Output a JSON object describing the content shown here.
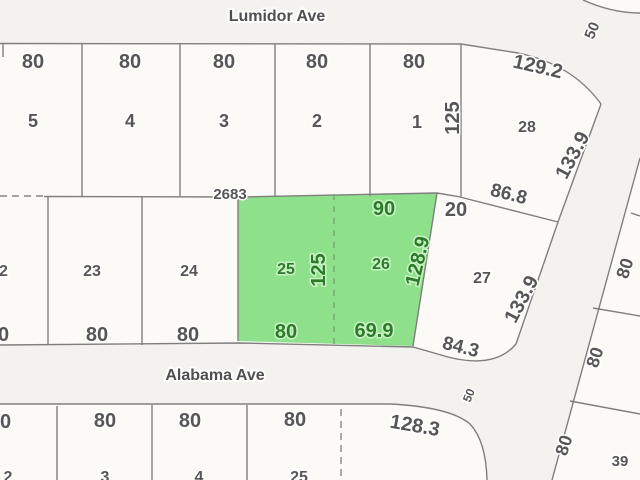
{
  "streets": {
    "north": "Lumidor Ave",
    "south": "Alabama Ave",
    "diagonal_width_top": "50",
    "intersection_width": "50"
  },
  "plat_number": "2683",
  "north_block": {
    "frontages": [
      "80",
      "80",
      "80",
      "80",
      "80"
    ],
    "lot_numbers": [
      "5",
      "4",
      "3",
      "2",
      "1"
    ],
    "depth": "125",
    "corner_lot": {
      "number": "28",
      "top_dim": "129.2",
      "side_dim": "133.9",
      "bottom_dim": "86.8"
    }
  },
  "middle_block": {
    "lot_numbers": [
      "22",
      "23",
      "24"
    ],
    "frontages": [
      "80",
      "80",
      "80"
    ],
    "east_lot": {
      "number": "27",
      "top_dim": "20",
      "side_dim": "133.9",
      "bottom_dim": "84.3"
    },
    "parcel": {
      "lot_numbers": [
        "25",
        "26"
      ],
      "top_dim": "90",
      "side_dim": "128.9",
      "depth": "125",
      "bottom_dims": [
        "80",
        "69.9"
      ]
    }
  },
  "south_block": {
    "frontages": [
      "80",
      "80",
      "80",
      "80"
    ],
    "lot_numbers": [
      "2",
      "3",
      "4",
      "25"
    ],
    "corner_dim": "128.3"
  },
  "east_block": {
    "frontages": [
      "80",
      "80",
      "80"
    ],
    "lot_number": "39"
  },
  "colors": {
    "parcel_fill": "#8fe08b",
    "parcel_text": "#2c7a2a",
    "line": "#7f7f7f",
    "text": "#565656",
    "background": "#f3f2ef"
  }
}
